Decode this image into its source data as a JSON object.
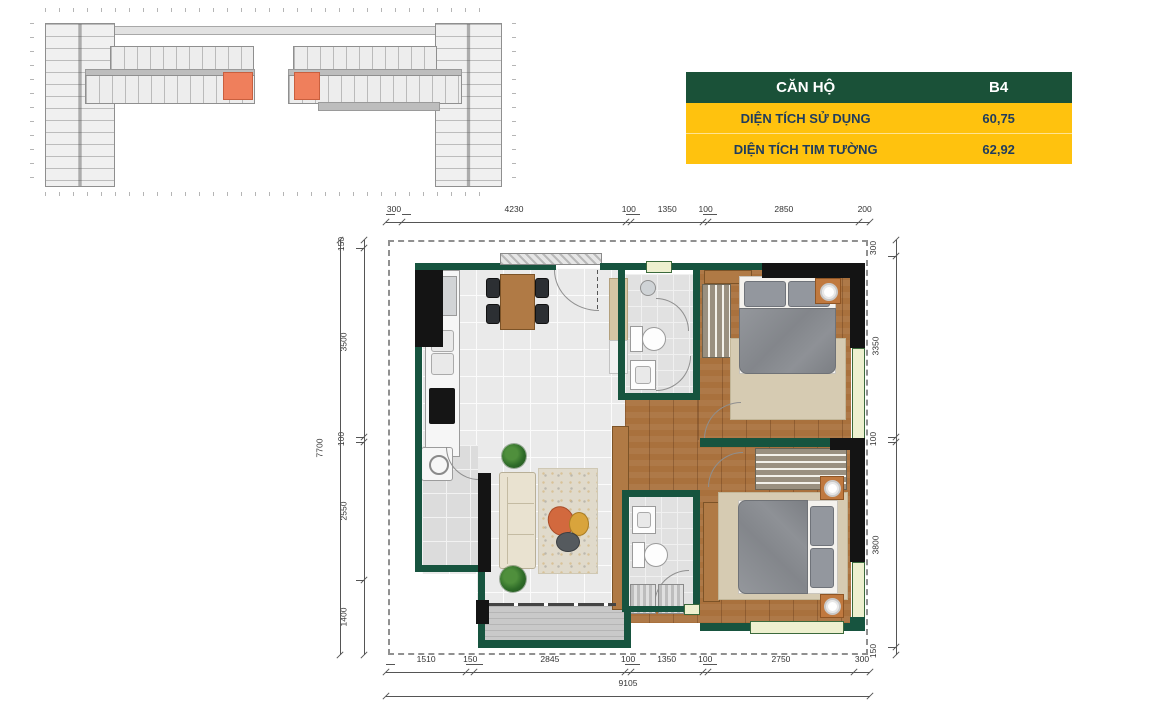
{
  "info_table": {
    "header": {
      "label": "CĂN HỘ",
      "unit": "B4"
    },
    "rows": [
      {
        "label": "DIỆN TÍCH SỬ DỤNG",
        "value": "60,75"
      },
      {
        "label": "DIỆN TÍCH TIM TƯỜNG",
        "value": "62,92"
      }
    ],
    "colors": {
      "header_bg": "#1a5138",
      "header_text": "#ffffff",
      "row_bg": "#ffc20e",
      "row_text": "#1f3c5e"
    }
  },
  "key_plan": {
    "description": "building-overview-floor-plate",
    "highlight_color": "#ef7f5c"
  },
  "floor_plan": {
    "wall_color": "#17543f",
    "column_color": "#141414",
    "window_color": "#eef0cf"
  },
  "dimensions": {
    "top": [
      "300",
      "4230",
      "100",
      "1350",
      "100",
      "2850",
      "200"
    ],
    "bottom": [
      "1510",
      "150",
      "2845",
      "100",
      "1350",
      "100",
      "2750",
      "300"
    ],
    "bottom_total": [
      "9105"
    ],
    "left": [
      "150",
      "3500",
      "100",
      "2550",
      "1400"
    ],
    "left_total": [
      "7700"
    ],
    "right": [
      "300",
      "3350",
      "100",
      "3800",
      "150"
    ]
  }
}
